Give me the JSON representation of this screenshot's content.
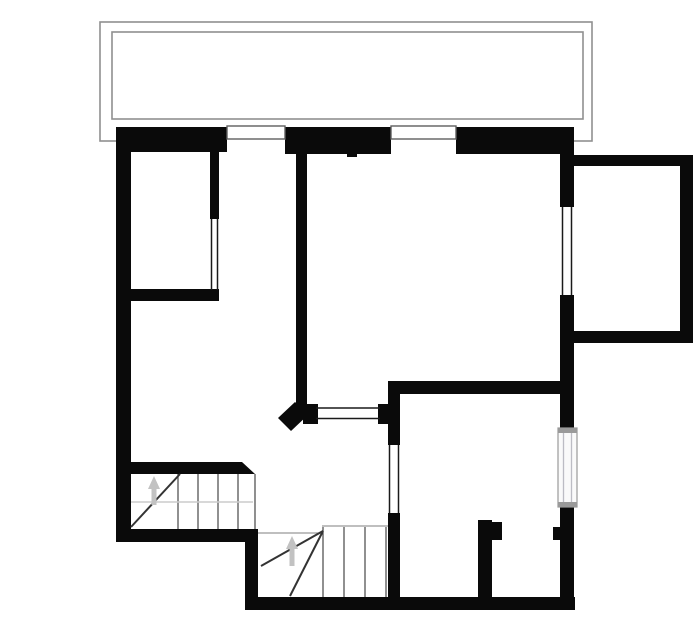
{
  "canvas": {
    "width": 700,
    "height": 644,
    "background": "#ffffff"
  },
  "palette": {
    "wall": "#0a0a0a",
    "balcony_outline": "#8f8f8f",
    "door_frame": "#5f5f5f",
    "glazing_line": "#1a1a1a",
    "stair_line": "#454545",
    "winder_line": "#333333",
    "faint_line": "#cccccc",
    "gray_line": "#999999",
    "arrow": "#c2c2c2",
    "window_fill": "#fafafa",
    "window_cap": "#9a9a9a",
    "window_inner_line": "#bcbcc4",
    "opening_fill": "#ffffff"
  },
  "plan": {
    "balcony": {
      "outer": {
        "x": 100,
        "y": 22,
        "w": 492,
        "h": 119
      },
      "inner": {
        "x": 112,
        "y": 32,
        "w": 471,
        "h": 87
      }
    },
    "walls": [
      {
        "name": "top-wall-left",
        "rect": [
          117,
          127,
          110,
          25
        ]
      },
      {
        "name": "top-wall-middle",
        "rect": [
          285,
          127,
          106,
          27
        ]
      },
      {
        "name": "top-wall-right",
        "rect": [
          456,
          127,
          118,
          27
        ]
      },
      {
        "name": "left-exterior-wall",
        "rect": [
          116,
          127,
          15,
          415
        ]
      },
      {
        "name": "bedroom-east-wall",
        "rect": [
          210,
          140,
          9,
          79
        ]
      },
      {
        "name": "bedroom-south-wall",
        "rect": [
          116,
          289,
          103,
          12
        ]
      },
      {
        "name": "hall-partition-wall",
        "rect": [
          296,
          140,
          11,
          272
        ]
      },
      {
        "name": "hatch-left-cap",
        "rect": [
          303,
          404,
          15,
          20
        ]
      },
      {
        "name": "hatch-right-cap",
        "rect": [
          378,
          404,
          12,
          20
        ]
      },
      {
        "name": "room-south-wall",
        "rect": [
          388,
          381,
          174,
          13
        ]
      },
      {
        "name": "divider-wall-upper",
        "rect": [
          388,
          381,
          12,
          64
        ]
      },
      {
        "name": "divider-wall-lower",
        "rect": [
          388,
          513,
          12,
          92
        ]
      },
      {
        "name": "right-wall-upper",
        "rect": [
          560,
          127,
          14,
          80
        ]
      },
      {
        "name": "right-wall-middle",
        "rect": [
          560,
          295,
          14,
          133
        ]
      },
      {
        "name": "right-wall-lower",
        "rect": [
          560,
          506,
          14,
          104
        ]
      },
      {
        "name": "annex-north-wall",
        "rect": [
          560,
          155,
          132,
          11
        ]
      },
      {
        "name": "annex-east-wall",
        "rect": [
          680,
          155,
          13,
          188
        ]
      },
      {
        "name": "annex-south-wall",
        "rect": [
          574,
          331,
          119,
          12
        ]
      },
      {
        "name": "stair-top-wall",
        "rect": [
          131,
          462,
          111,
          12
        ]
      },
      {
        "name": "bottom-wall-west",
        "rect": [
          116,
          529,
          142,
          13
        ]
      },
      {
        "name": "stair-step-wall",
        "rect": [
          245,
          529,
          13,
          81
        ]
      },
      {
        "name": "bottom-wall-south",
        "rect": [
          245,
          597,
          330,
          13
        ]
      },
      {
        "name": "closet-wall",
        "rect": [
          478,
          520,
          14,
          78
        ]
      },
      {
        "name": "closet-door-jamb",
        "rect": [
          492,
          522,
          10,
          18
        ]
      },
      {
        "name": "right-door-jamb",
        "rect": [
          553,
          527,
          9,
          13
        ]
      },
      {
        "name": "wall-nub",
        "rect": [
          347,
          153,
          10,
          4
        ]
      }
    ],
    "polygons": [
      {
        "name": "stair-wall-chamfer",
        "points": "242,462 255,474 242,474"
      },
      {
        "name": "hall-wall-end-cap",
        "points": "295,402 309,414 291,431 278,418"
      }
    ],
    "openings": [
      {
        "name": "balcony-door-opening-left",
        "rect": [
          227,
          127,
          58,
          27
        ]
      },
      {
        "name": "balcony-door-opening-right",
        "rect": [
          391,
          127,
          65,
          27
        ]
      },
      {
        "name": "window-opening-right",
        "rect": [
          559,
          207,
          16,
          88
        ]
      }
    ],
    "door_frames": [
      {
        "name": "balcony-door-left",
        "rect": [
          227,
          126,
          58,
          13
        ]
      },
      {
        "name": "balcony-door-right",
        "rect": [
          391,
          126,
          65,
          13
        ]
      }
    ],
    "glazing_lines": [
      {
        "name": "right-window-glass",
        "x1": 562.5,
        "y1": 207,
        "x2": 562.5,
        "y2": 295
      },
      {
        "name": "right-window-glass",
        "x1": 571.5,
        "y1": 207,
        "x2": 571.5,
        "y2": 295
      },
      {
        "name": "divider-window-glass",
        "x1": 389.5,
        "y1": 445,
        "x2": 389.5,
        "y2": 513
      },
      {
        "name": "divider-window-glass",
        "x1": 398.5,
        "y1": 445,
        "x2": 398.5,
        "y2": 513
      },
      {
        "name": "bedroom-partition-glass",
        "x1": 211.5,
        "y1": 219,
        "x2": 211.5,
        "y2": 290
      },
      {
        "name": "bedroom-partition-glass",
        "x1": 217.5,
        "y1": 219,
        "x2": 217.5,
        "y2": 290
      },
      {
        "name": "hatch-glass",
        "x1": 316,
        "y1": 408,
        "x2": 380,
        "y2": 408
      },
      {
        "name": "hatch-glass",
        "x1": 316,
        "y1": 418.5,
        "x2": 380,
        "y2": 418.5
      }
    ],
    "gray_window": {
      "name": "lower-right-window",
      "frame": [
        558,
        428,
        19,
        79
      ],
      "caps": [
        [
          558,
          428,
          19,
          5
        ],
        [
          558,
          502,
          19,
          5
        ]
      ],
      "inner_lines": [
        {
          "x1": 563.5,
          "y1": 433,
          "x2": 563.5,
          "y2": 502
        },
        {
          "x1": 571.5,
          "y1": 433,
          "x2": 571.5,
          "y2": 502
        }
      ]
    },
    "stairs": {
      "flight1": {
        "name": "stair-flight-upper",
        "tread_x": [
          178,
          198,
          218,
          238,
          255
        ],
        "tread_y": [
          474,
          529
        ],
        "diagonals": [
          {
            "x1": 131,
            "y1": 527,
            "x2": 180,
            "y2": 474
          }
        ],
        "faint_lines": [
          {
            "x1": 131,
            "y1": 502,
            "x2": 253,
            "y2": 502
          }
        ],
        "arrow": {
          "stem": [
            154,
            505,
            154,
            487
          ],
          "head": "154,476 148,489 160,489"
        }
      },
      "flight2": {
        "name": "stair-flight-lower",
        "tread_x": [
          323,
          344,
          365,
          386
        ],
        "tread_y": [
          527,
          597
        ],
        "diagonals": [
          {
            "x1": 323,
            "y1": 531,
            "x2": 261,
            "y2": 566
          },
          {
            "x1": 323,
            "y1": 531,
            "x2": 290,
            "y2": 596
          }
        ],
        "gray_lines": [
          {
            "x1": 322,
            "y1": 526,
            "x2": 388,
            "y2": 526
          },
          {
            "x1": 258,
            "y1": 533,
            "x2": 322,
            "y2": 533
          }
        ],
        "arrow": {
          "stem": [
            292,
            566,
            292,
            548
          ],
          "head": "292,536 286,549 298,549"
        }
      }
    }
  }
}
